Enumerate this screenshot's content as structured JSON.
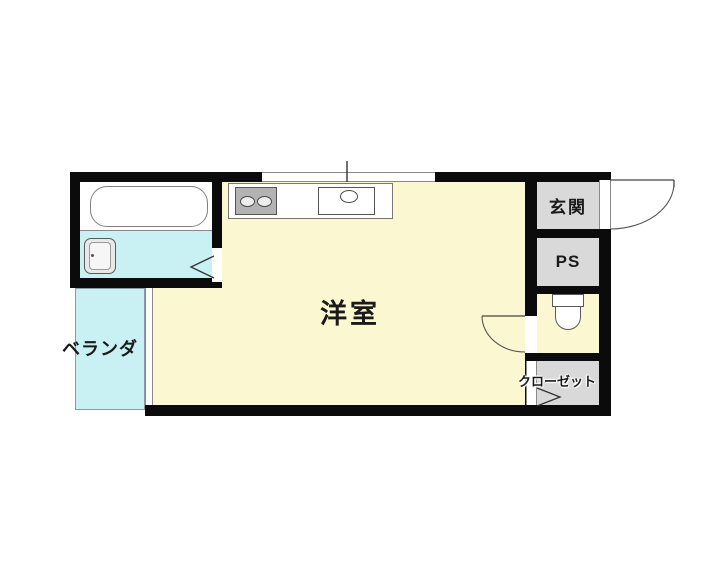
{
  "plan": {
    "type": "japanese-apartment-floor-plan",
    "rooms": {
      "main_room": {
        "label": "洋室",
        "color": "#FBF7D0"
      },
      "veranda": {
        "label": "ベランダ",
        "color": "#C9F0F3"
      },
      "entrance": {
        "label": "玄関",
        "color": "#D9D9D9"
      },
      "pipe_space": {
        "label": "PS",
        "color": "#D9D9D9"
      },
      "closet": {
        "label": "クローゼット",
        "color": "#D9D9D9"
      },
      "bathroom": {
        "label": "",
        "color": "#C9F0F3"
      },
      "toilet_room": {
        "label": "",
        "color": "#FBF7D0"
      }
    },
    "fixtures": [
      "bathtub",
      "wash-basin",
      "gas-stove-2-burner",
      "kitchen-sink",
      "toilet",
      "entrance-door-swing",
      "toilet-door-swing",
      "bathroom-folding-door",
      "closet-folding-door",
      "top-window",
      "veranda-window"
    ],
    "colors": {
      "wall": "#0b0b0b",
      "background": "#ffffff",
      "thin_line": "#777777"
    }
  }
}
